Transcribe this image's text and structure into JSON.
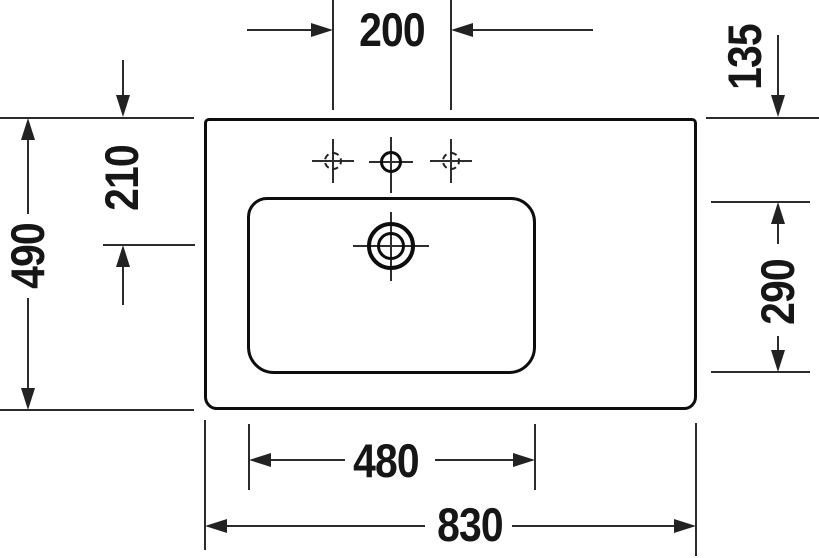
{
  "style": {
    "background": "#ffffff",
    "outline_color": "#0d0d0d",
    "dimension_line_color": "#2b2b2b",
    "text_color": "#161616"
  },
  "drawing": {
    "kind": "washbasin-top-view-technical-drawing",
    "dims": {
      "tap_hole_spacing": "200",
      "back_ledge_depth": "135",
      "overall_depth": "490",
      "back_to_drain": "210",
      "basin_depth": "290",
      "basin_width": "480",
      "overall_width": "830"
    }
  }
}
